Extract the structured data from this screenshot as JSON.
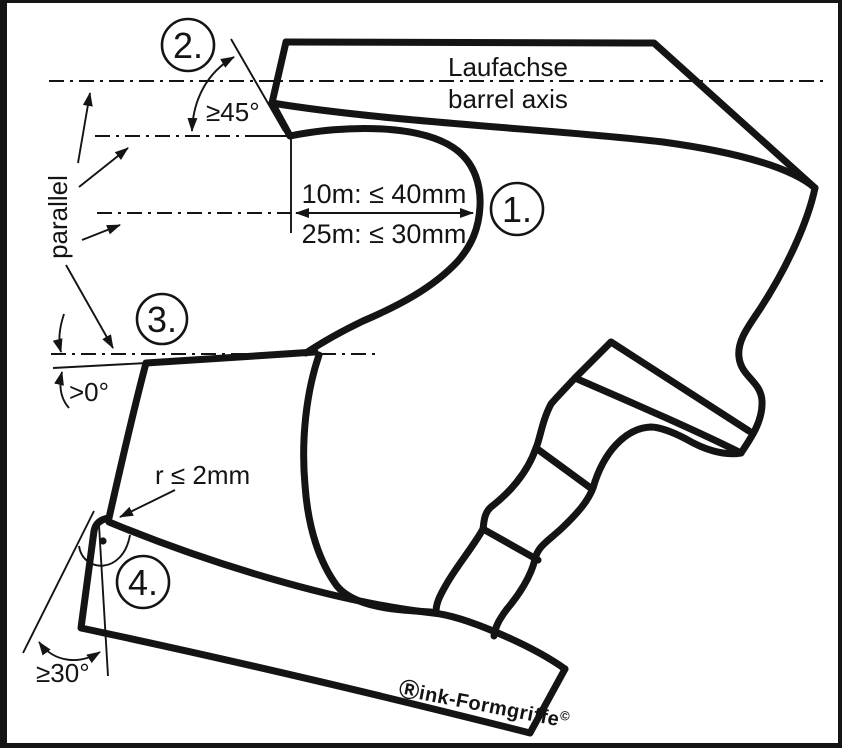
{
  "diagram": {
    "description": "Pistol grip rule drawing (Rink anatomical grip) with ISSF measurement callouts",
    "colors": {
      "ink": "#141414",
      "background": "#ffffff"
    },
    "axis": {
      "label_de": "Laufachse",
      "label_en": "barrel axis"
    },
    "parallel_label": "parallel",
    "dimensions": {
      "line_10m": "10m: ≤ 40mm",
      "line_25m": "25m: ≤ 30mm"
    },
    "angles": {
      "grip_top": "≥45°",
      "thumb_shelf": ">0°",
      "heel": "≥30°",
      "radius": "r ≤ 2mm"
    },
    "callouts": [
      {
        "label": "1."
      },
      {
        "label": "2."
      },
      {
        "label": "3."
      },
      {
        "label": "4."
      }
    ],
    "watermark": {
      "mark": "Ⓡ",
      "name": "ink-Formgriffe",
      "copyright": "©"
    }
  }
}
